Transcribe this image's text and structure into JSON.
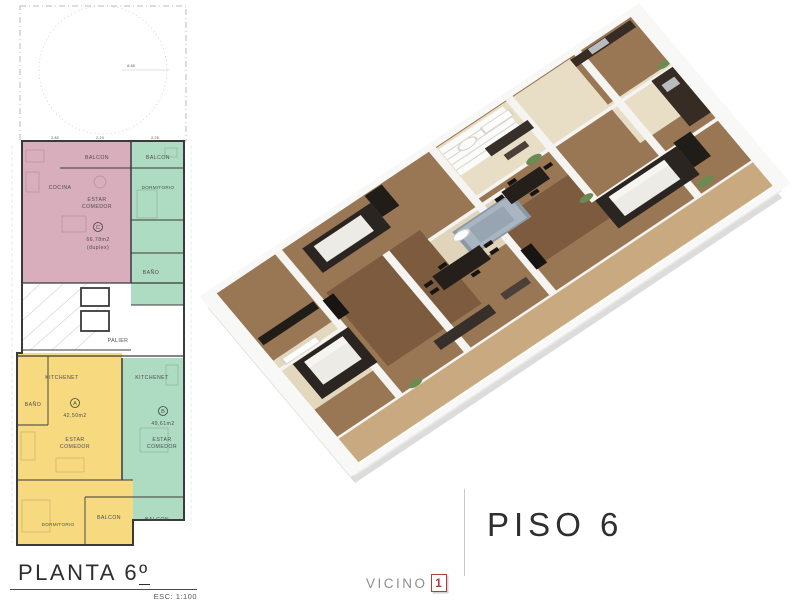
{
  "plan2d": {
    "title": "PLANTA 6",
    "ordinal": "º",
    "scale": "ESC: 1:100",
    "dim_radius": "6.45",
    "dims": {
      "d1": "2.80",
      "d2": "2.20",
      "d3": "2.25"
    },
    "units": {
      "c": {
        "id": "C",
        "area": "66,78m2",
        "note": "(duplex)",
        "color": "#d9aebc"
      },
      "a": {
        "id": "A",
        "area": "42,50m2",
        "color": "#f7da7f"
      },
      "b": {
        "id": "B",
        "area": "49,61m2",
        "color": "#aedcc3"
      }
    },
    "labels": {
      "c_balcon": "BALCON",
      "c_cocina": "COCINA",
      "c_estar1": "ESTAR",
      "c_estar2": "COMEDOR",
      "g_balcon": "BALCON",
      "g_dormitorio": "DORMITORIO",
      "g_bano": "BAÑO",
      "palier": "PALIER",
      "a_kitchenet": "KITCHENET",
      "a_bano": "BAÑO",
      "a_estar1": "ESTAR",
      "a_estar2": "COMEDOR",
      "a_dormitorio": "DORMITORIO",
      "a_balcon": "BALCON",
      "b_kitchenet": "KITCHENET",
      "b_estar1": "ESTAR",
      "b_estar2": "COMEDOR",
      "b_balcon": "BALCON"
    }
  },
  "caption": {
    "floor": "PISO 6"
  },
  "brand": {
    "name": "VICINO",
    "number": "1",
    "accent_red": "#b13c3c"
  }
}
